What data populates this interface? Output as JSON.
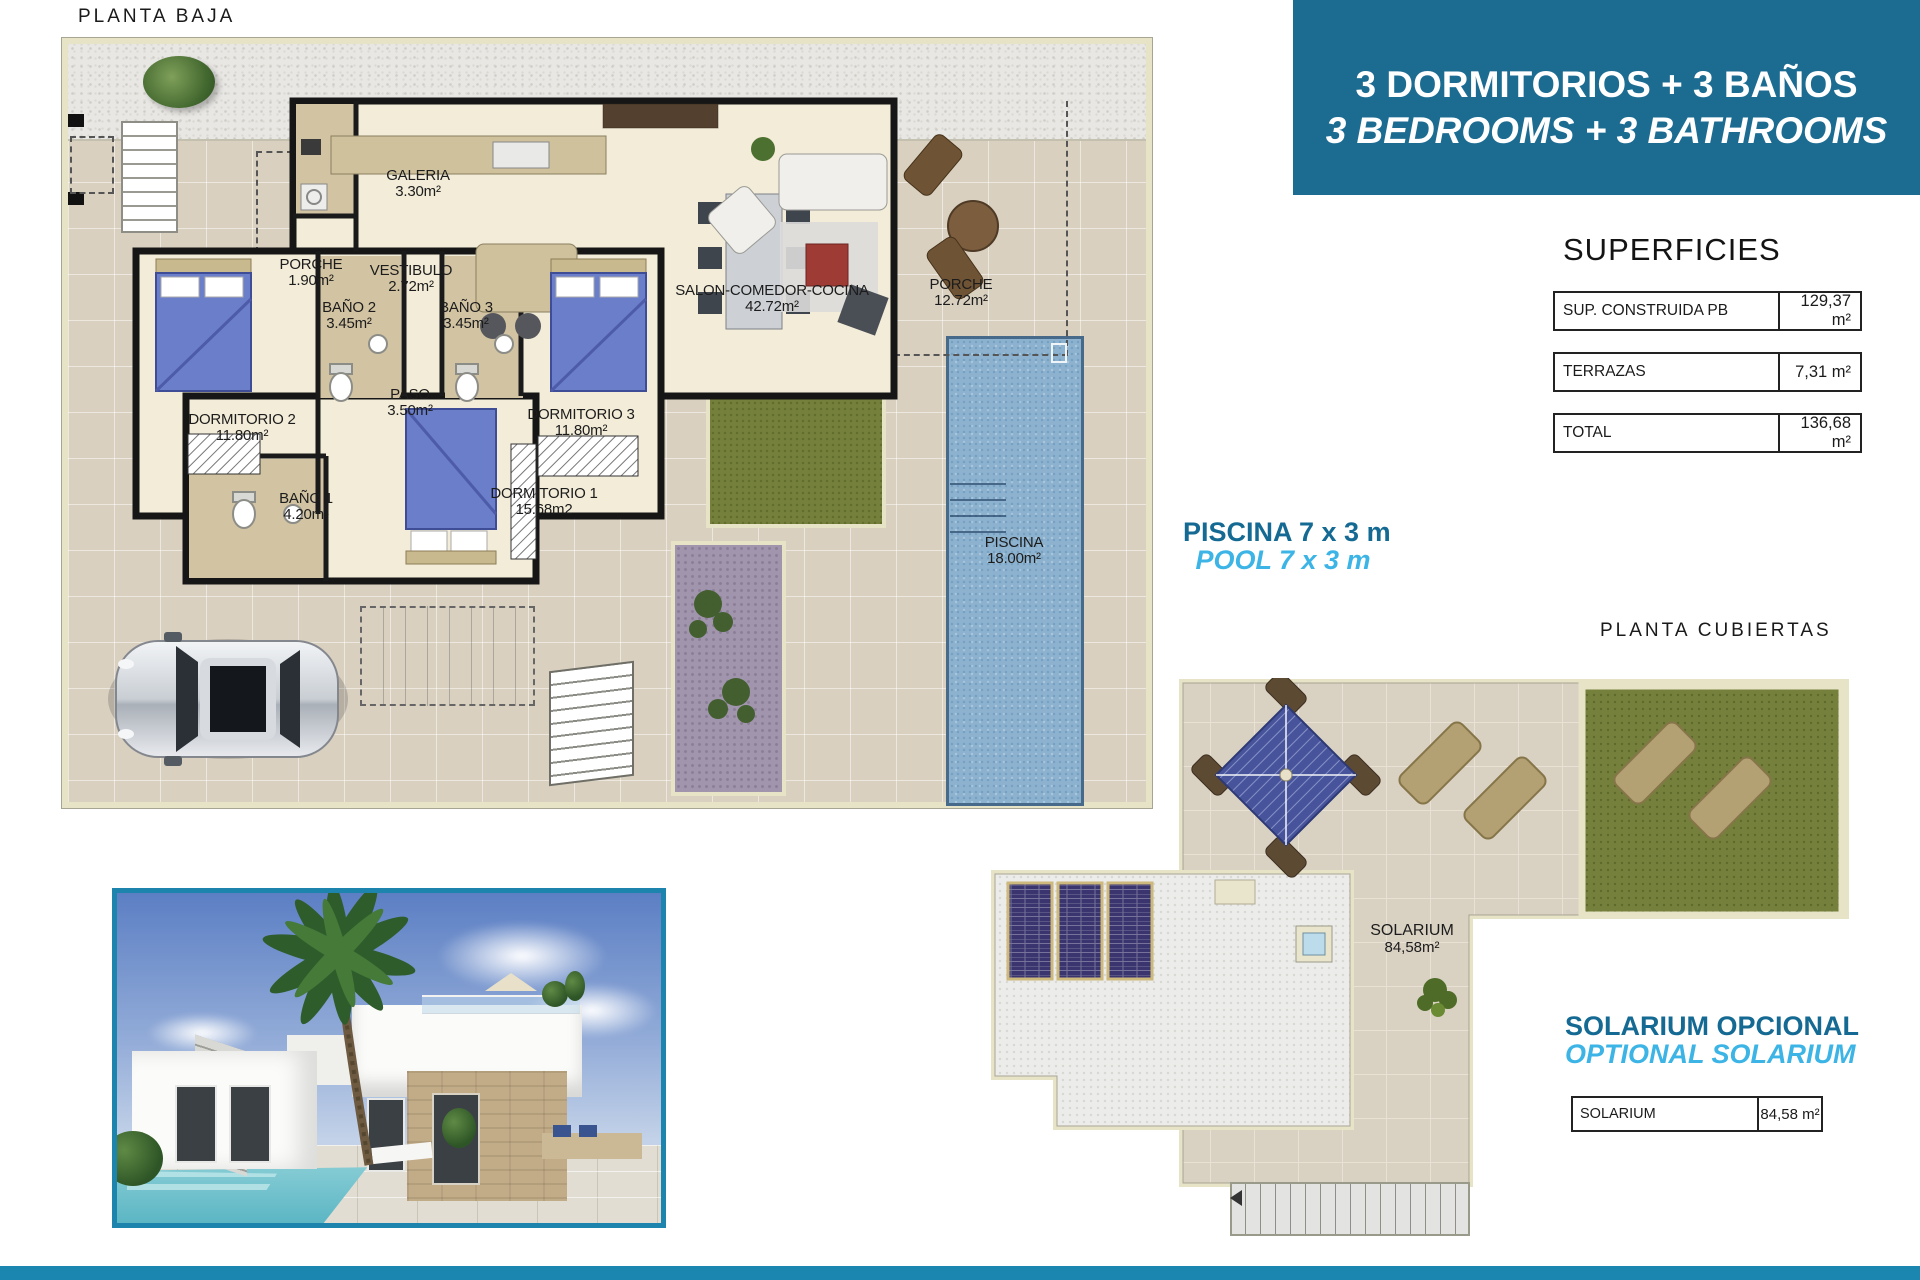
{
  "titles": {
    "ground": "PLANTA BAJA",
    "roof": "PLANTA CUBIERTAS"
  },
  "banner": {
    "line1": "3 DORMITORIOS + 3 BAÑOS",
    "line2": "3 BEDROOMS + 3 BATHROOMS",
    "bg_color": "#1c6c92",
    "text_color": "#ffffff"
  },
  "superficies": {
    "title": "SUPERFICIES",
    "rows": [
      {
        "label": "SUP. CONSTRUIDA PB",
        "value": "129,37 m²"
      },
      {
        "label": "TERRAZAS",
        "value": "7,31 m²"
      },
      {
        "label": "TOTAL",
        "value": "136,68 m²"
      }
    ]
  },
  "pool_note": {
    "line1": "PISCINA 7 x 3 m",
    "line2": "POOL 7 x 3 m"
  },
  "solarium_note": {
    "line1": "SOLARIUM OPCIONAL",
    "line2": "OPTIONAL SOLARIUM"
  },
  "solarium_table": {
    "label": "SOLARIUM",
    "value": "84,58 m²"
  },
  "ground_rooms": {
    "galeria": {
      "name": "GALERIA",
      "area": "3.30m²"
    },
    "porche1": {
      "name": "PORCHE",
      "area": "1.90m²"
    },
    "vestibulo": {
      "name": "VESTIBULO",
      "area": "2.72m²"
    },
    "salon": {
      "name": "SALON-COMEDOR-COCINA",
      "area": "42.72m²"
    },
    "porche2": {
      "name": "PORCHE",
      "area": "12.72m²"
    },
    "bano2": {
      "name": "BAÑO 2",
      "area": "3.45m²"
    },
    "bano3": {
      "name": "BAÑO 3",
      "area": "3.45m²"
    },
    "paso": {
      "name": "PASO",
      "area": "3.50m²"
    },
    "dorm2": {
      "name": "DORMITORIO 2",
      "area": "11.80m²"
    },
    "dorm3": {
      "name": "DORMITORIO 3",
      "area": "11.80m²"
    },
    "bano1": {
      "name": "BAÑO 1",
      "area": "4.20m²"
    },
    "dorm1": {
      "name": "DORMITORIO 1",
      "area": "15.68m2"
    },
    "piscina": {
      "name": "PISCINA",
      "area": "18.00m²"
    }
  },
  "roof_label": {
    "name": "SOLARIUM",
    "area": "84,58m²"
  },
  "colors": {
    "accent_dark": "#156a93",
    "accent_light": "#3cb4e5",
    "footer_bg": "#1b86b0",
    "plan_tile": "#d9d0c0",
    "grass": "#75803c",
    "pool": "#8cb2cf",
    "solar_panel": "#3b356f"
  }
}
